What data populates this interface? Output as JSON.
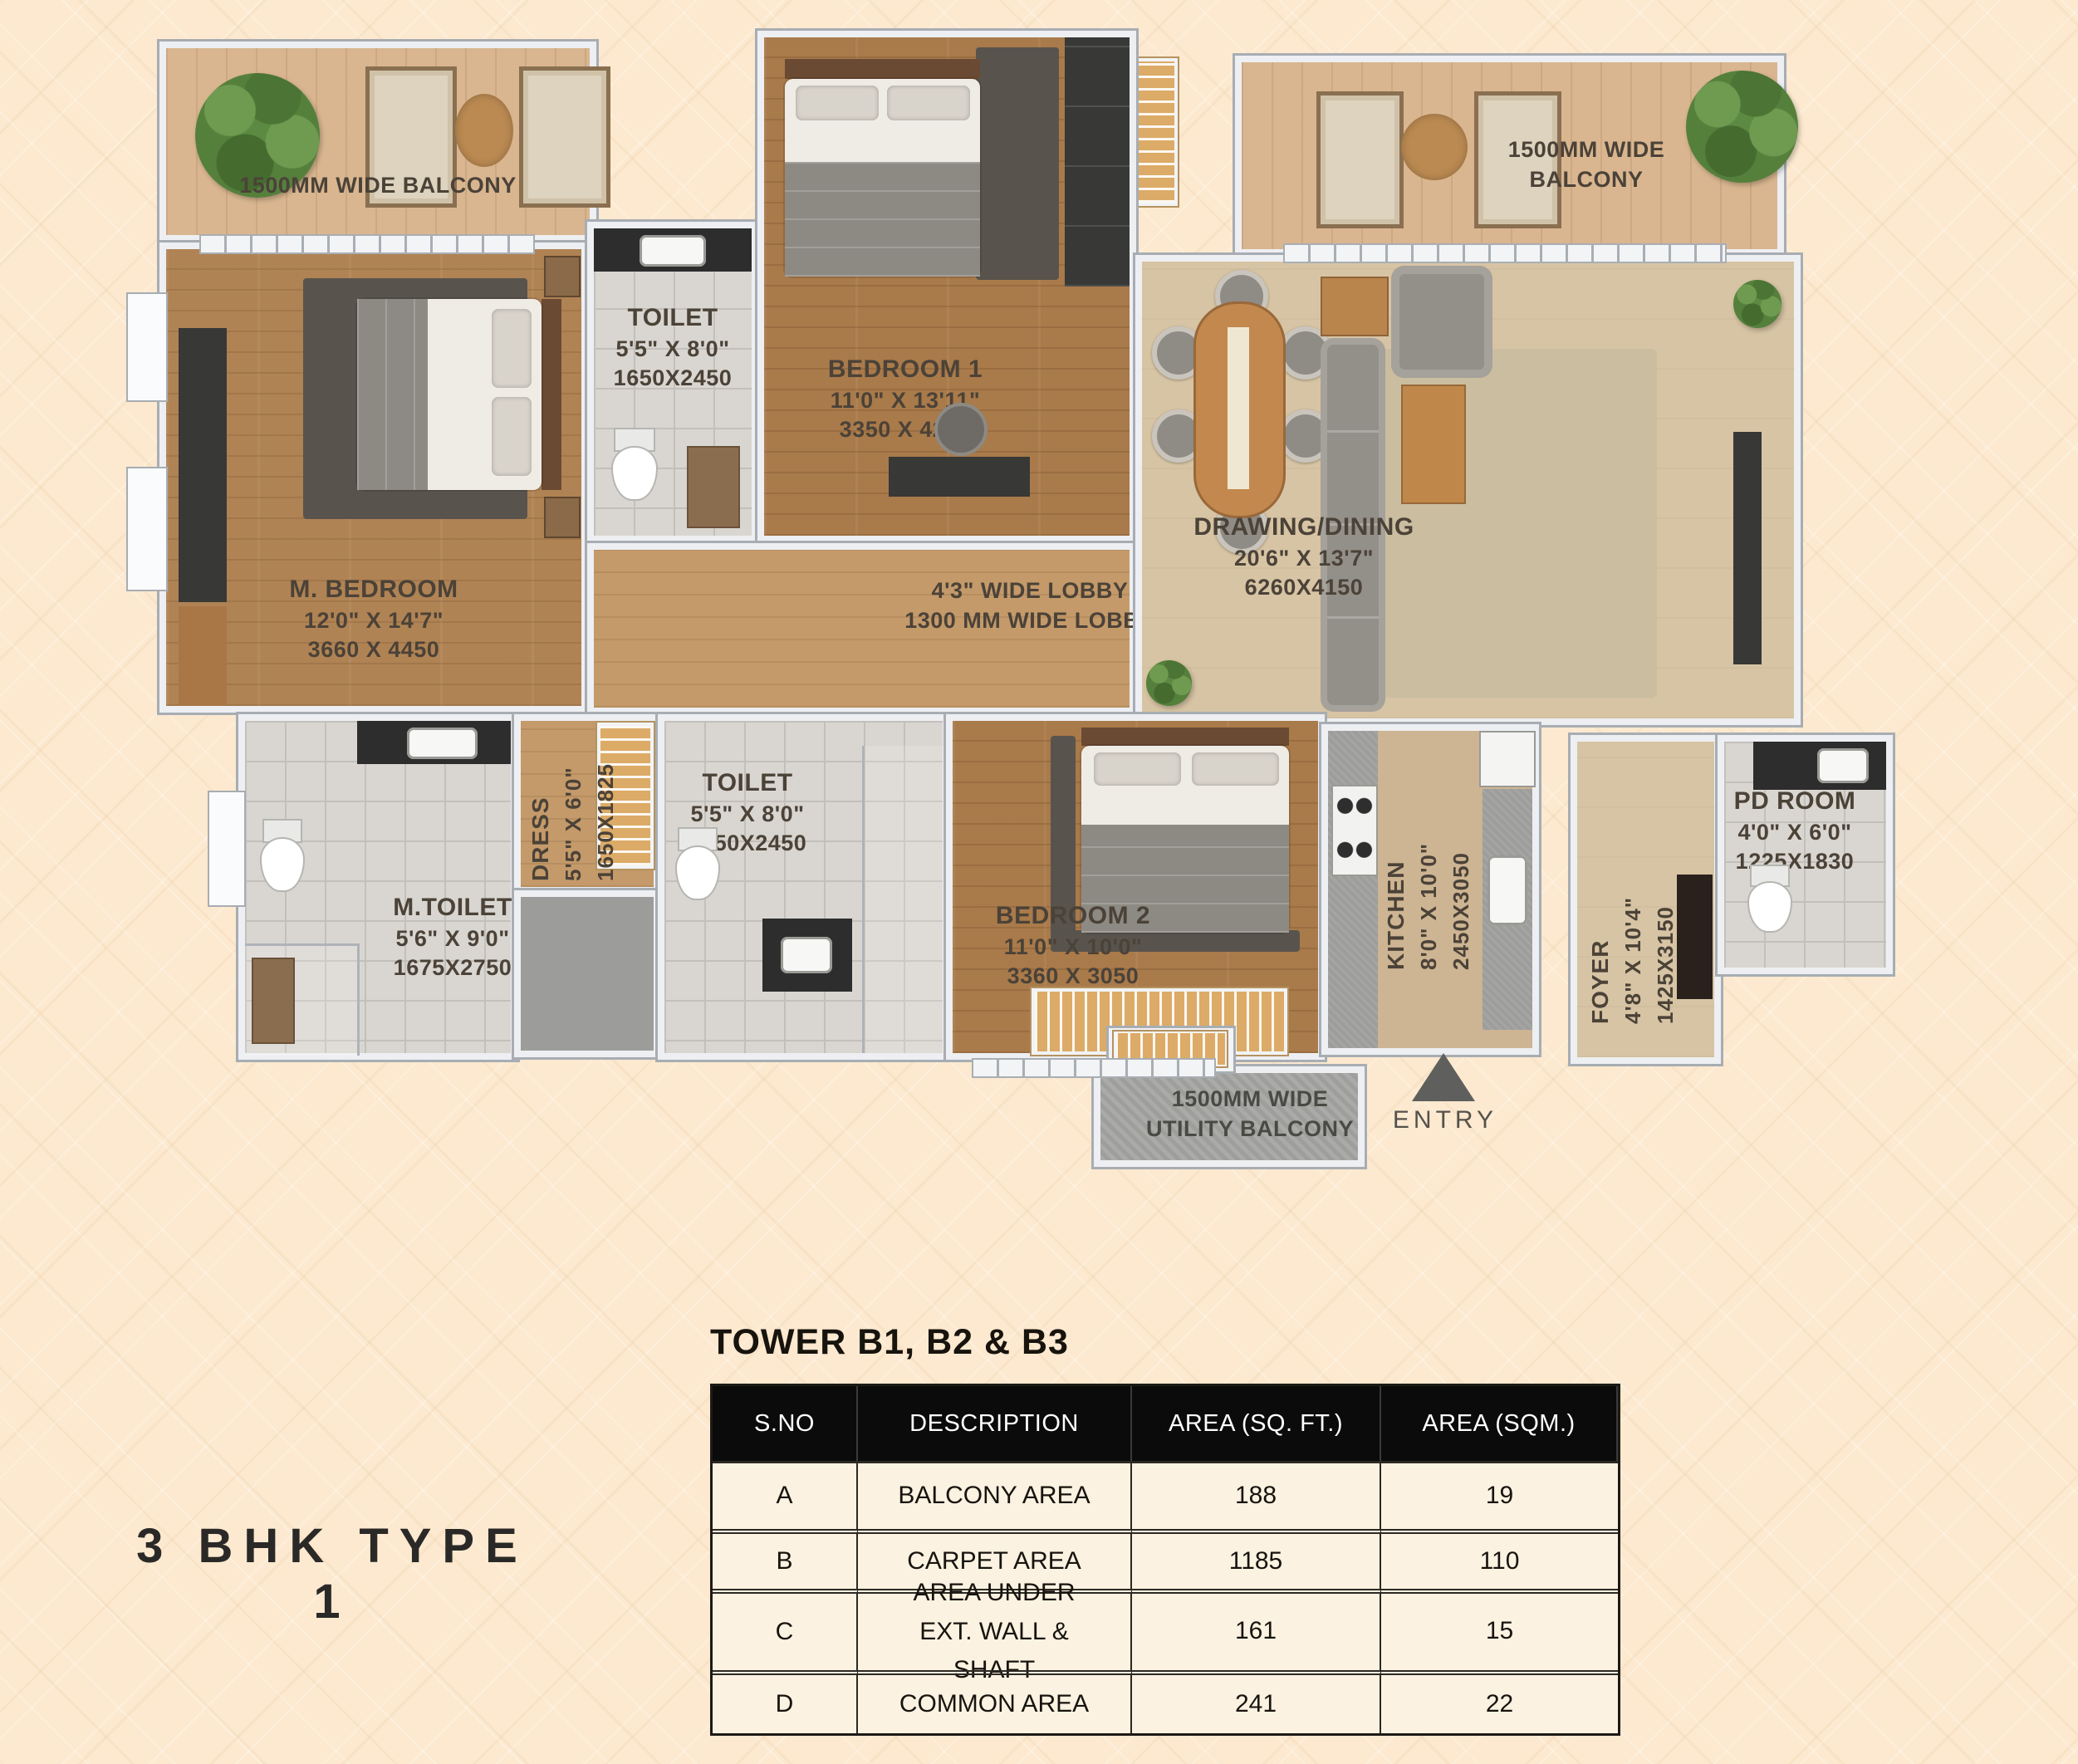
{
  "page_title": "3 BHK TYPE 1",
  "plan": {
    "balconies": {
      "top_left": {
        "label": "1500MM WIDE BALCONY"
      },
      "top_right": {
        "line1": "1500MM WIDE",
        "line2": "BALCONY"
      },
      "utility": {
        "line1": "1500MM WIDE",
        "line2": "UTILITY BALCONY"
      }
    },
    "rooms": {
      "m_bedroom": {
        "name": "M. BEDROOM",
        "dim_ft": "12'0\" X 14'7\"",
        "dim_mm": "3660 X 4450"
      },
      "toilet_top": {
        "name": "TOILET",
        "dim_ft": "5'5\" X 8'0\"",
        "dim_mm": "1650X2450"
      },
      "bedroom_1": {
        "name": "BEDROOM 1",
        "dim_ft": "11'0\" X 13'11\"",
        "dim_mm": "3350 X 4250"
      },
      "drawing_dining": {
        "name": "DRAWING/DINING",
        "dim_ft": "20'6\" X 13'7\"",
        "dim_mm": "6260X4150"
      },
      "lobby": {
        "line1": "4'3\" WIDE LOBBY",
        "line2": "1300 MM WIDE LOBBY"
      },
      "dress": {
        "name": "DRESS",
        "dim_ft": "5'5\" X 6'0\"",
        "dim_mm": "1650X1825"
      },
      "toilet_mid": {
        "name": "TOILET",
        "dim_ft": "5'5\" X 8'0\"",
        "dim_mm": "1650X2450"
      },
      "m_toilet": {
        "name": "M.TOILET",
        "dim_ft": "5'6\" X 9'0\"",
        "dim_mm": "1675X2750"
      },
      "bedroom_2": {
        "name": "BEDROOM 2",
        "dim_ft": "11'0\" X 10'0\"",
        "dim_mm": "3360 X 3050"
      },
      "kitchen": {
        "name": "KITCHEN",
        "dim_ft": "8'0\" X 10'0\"",
        "dim_mm": "2450X3050"
      },
      "foyer": {
        "name": "FOYER",
        "dim_ft": "4'8\" X 10'4\"",
        "dim_mm": "1425X3150"
      },
      "pd_room": {
        "name": "PD ROOM",
        "dim_ft": "4'0\" X 6'0\"",
        "dim_mm": "1225X1830"
      }
    },
    "entry_label": "ENTRY"
  },
  "area_table": {
    "title": "TOWER B1, B2 & B3",
    "headers": [
      "S.NO",
      "DESCRIPTION",
      "AREA (SQ. FT.)",
      "AREA (SQM.)"
    ],
    "rows": [
      {
        "sno": "A",
        "description": "BALCONY AREA",
        "sqft": "188",
        "sqm": "19"
      },
      {
        "sno": "B",
        "description": "CARPET AREA",
        "sqft": "1185",
        "sqm": "110"
      },
      {
        "sno": "C",
        "description": "AREA UNDER EXT. WALL & SHAFT",
        "sqft": "161",
        "sqm": "15"
      },
      {
        "sno": "D",
        "description": "COMMON AREA",
        "sqft": "241",
        "sqm": "22"
      }
    ]
  },
  "colors": {
    "background": "#fce9cf",
    "table_header_bg": "#0b0b0b",
    "table_row_bg": "#fbf2e1",
    "plan_label_text": "#4b4238",
    "entry_arrow": "#5f5f5d",
    "wall": "#edeff2"
  }
}
